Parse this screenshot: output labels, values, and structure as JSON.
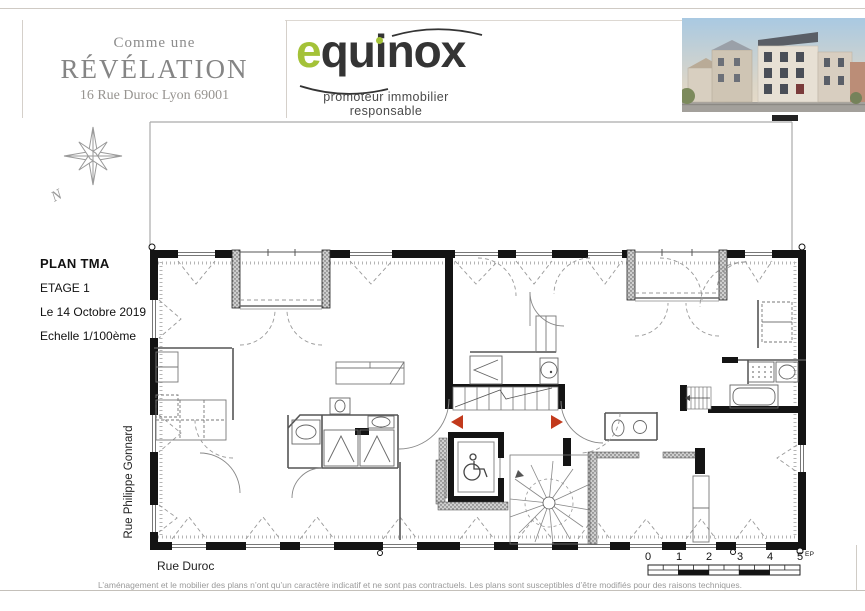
{
  "header": {
    "brand_block": {
      "line1": "Comme une",
      "line2": "RÉVÉLATION",
      "line3": "16 Rue Duroc Lyon 69001"
    },
    "logo": {
      "text_green": "e",
      "text_dark_1": "qu",
      "text_dark_2": "inox",
      "subtitle": "promoteur immobilier responsable"
    }
  },
  "plan_info": {
    "title": "PLAN TMA",
    "floor": "ETAGE 1",
    "date": "Le 14 Octobre 2019",
    "scale": "Echelle 1/100ème"
  },
  "compass": {
    "north_label": "N"
  },
  "streets": {
    "left_vertical": "Rue Philippe Gonnard",
    "bottom": "Rue Duroc"
  },
  "scale_bar": {
    "labels": [
      "0",
      "1",
      "2",
      "3",
      "4",
      "5"
    ],
    "marker_label": "EP"
  },
  "footer": {
    "disclaimer": "L’aménagement et le mobilier des plans n’ont qu’un caractère indicatif et ne sont pas contractuels. Les plans sont susceptibles d’être modifiés pour des raisons techniques."
  },
  "colors": {
    "logo_green": "#a4c238",
    "entry_arrow_red": "#c23a1c",
    "wall_black": "#141414",
    "frame_gray": "#aaaaaa"
  }
}
